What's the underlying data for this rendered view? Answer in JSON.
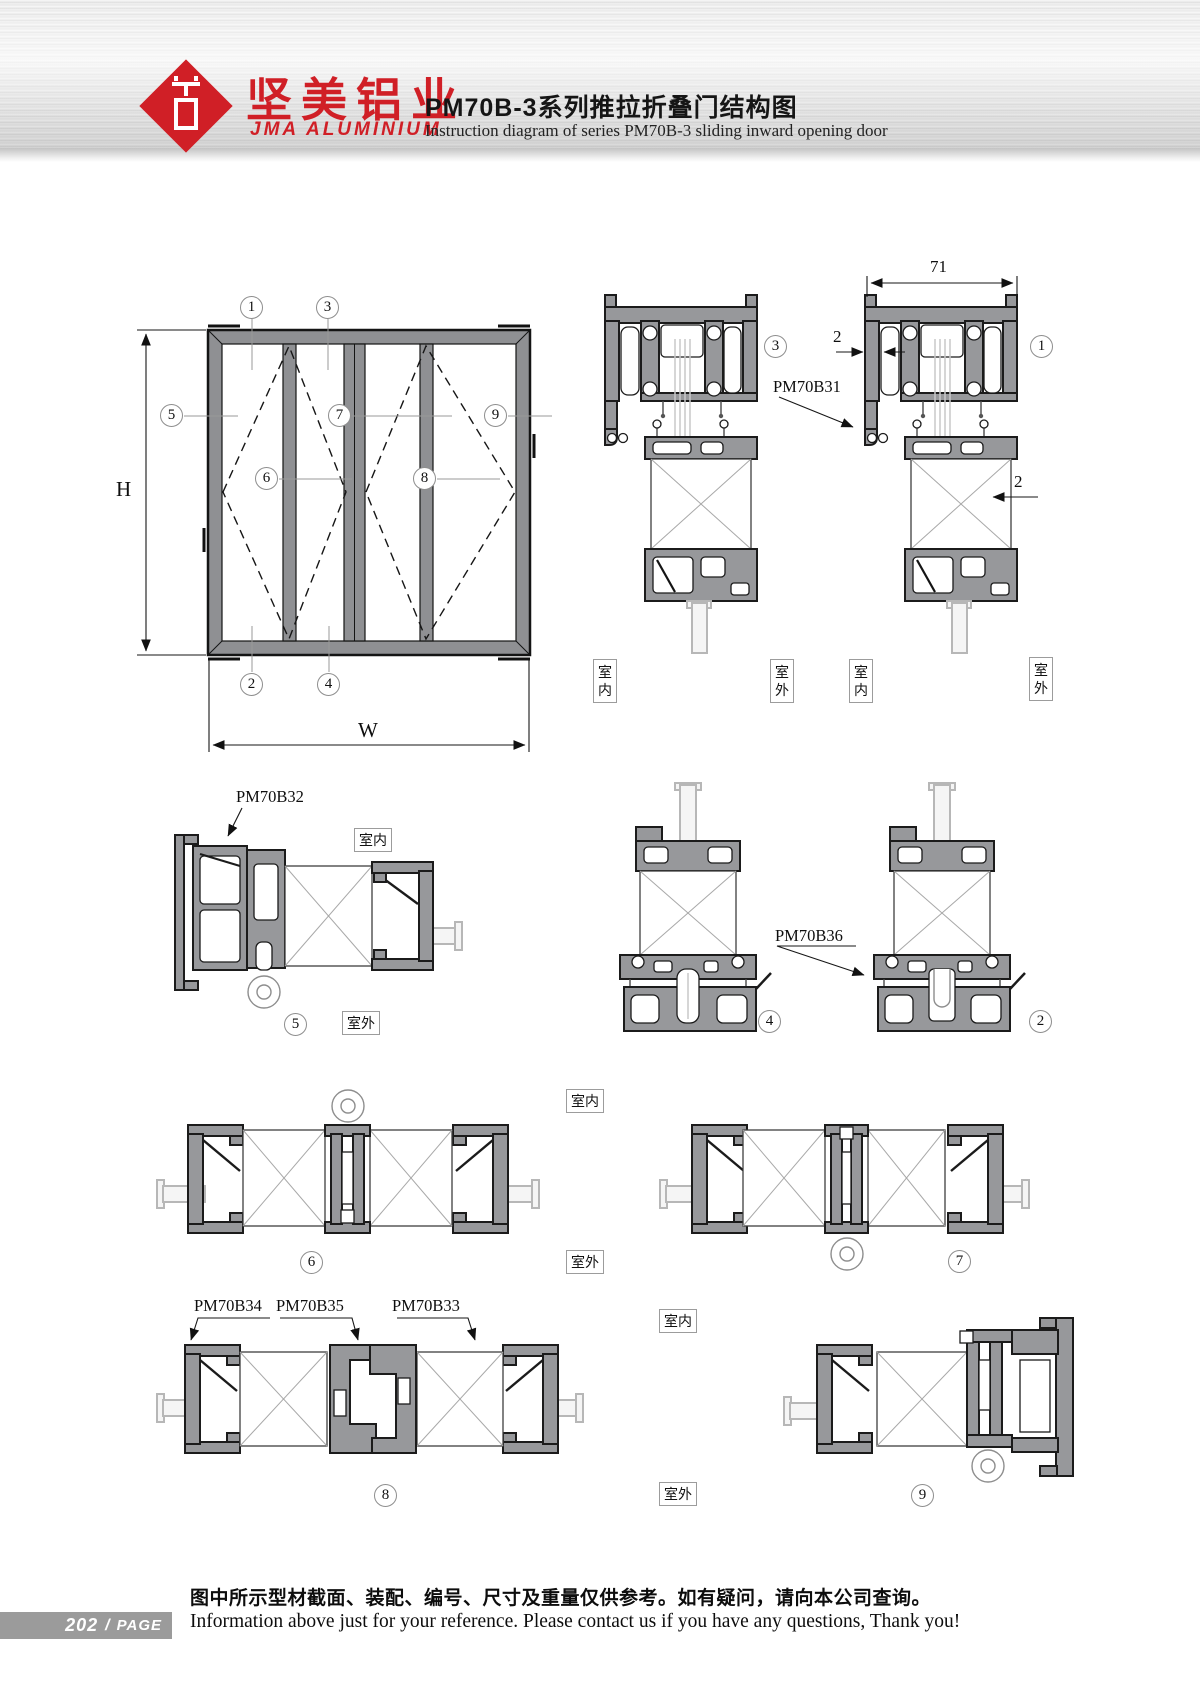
{
  "header": {
    "logo_cn": "坚美铝业",
    "logo_en": "JMA ALUMINIUM",
    "title_cn": "PM70B-3系列推拉折叠门结构图",
    "title_en": "Instruction diagram of series PM70B-3 sliding inward opening door"
  },
  "elevation": {
    "dim_height": "H",
    "dim_width": "W"
  },
  "dims": {
    "track_width": "71",
    "wall_thickness_left": "2",
    "wall_thickness_right": "2"
  },
  "rooms": {
    "indoor": "室内",
    "outdoor": "室外"
  },
  "profile_codes": {
    "pm70b31": "PM70B31",
    "pm70b32": "PM70B32",
    "pm70b33": "PM70B33",
    "pm70b34": "PM70B34",
    "pm70b35": "PM70B35",
    "pm70b36": "PM70B36"
  },
  "callouts": {
    "n1": "1",
    "n2": "2",
    "n3": "3",
    "n4": "4",
    "n5": "5",
    "n6": "6",
    "n7": "7",
    "n8": "8",
    "n9": "9"
  },
  "colors": {
    "brand_red": "#d01f26",
    "profile_gray": "#97989b",
    "line_dark": "#1b1b1b"
  },
  "footer": {
    "page_number": "202",
    "page_separator": "/",
    "page_label": "PAGE",
    "note_cn": "图中所示型材截面、装配、编号、尺寸及重量仅供参考。如有疑问，请向本公司查询。",
    "note_en": "Information above just for your reference. Please contact us if you have any questions, Thank you!"
  }
}
